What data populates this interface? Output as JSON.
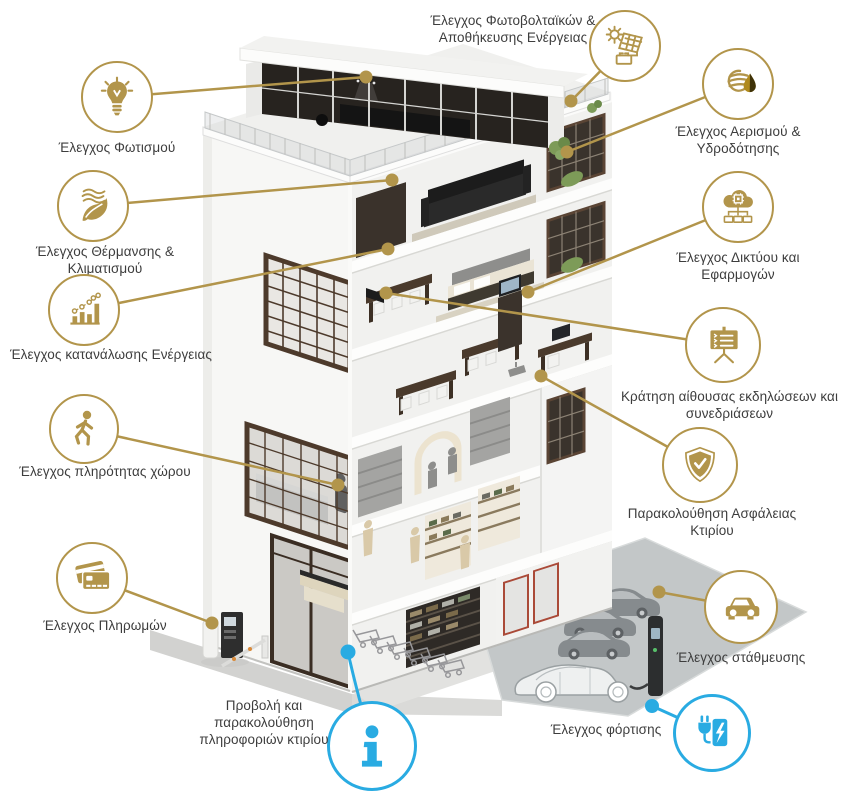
{
  "figure": {
    "type": "smart-building-infographic",
    "colors": {
      "accent_gold": "#b2954b",
      "accent_blue": "#29abe2",
      "label_text": "#3d3d3d"
    }
  },
  "callouts": [
    {
      "id": "lighting",
      "icon": "lightbulb-icon",
      "label": "Έλεγχος Φωτισμού"
    },
    {
      "id": "solar",
      "icon": "solar-panel-battery-icon",
      "label": "Έλεγχος Φωτοβολταϊκών & Αποθήκευσης Ενέργειας"
    },
    {
      "id": "ventilation",
      "icon": "airflow-waterdrop-icon",
      "label": "Έλεγχος Αερισμού & Υδροδότησης"
    },
    {
      "id": "hvac",
      "icon": "leaf-breeze-icon",
      "label": "Έλεγχος Θέρμανσης & Κλιματισμού"
    },
    {
      "id": "network",
      "icon": "cloud-network-icon",
      "label": "Έλεγχος Δικτύου και Εφαρμογών"
    },
    {
      "id": "energy",
      "icon": "bar-chart-icon",
      "label": "Έλεγχος κατανάλωσης Ενέργειας"
    },
    {
      "id": "meeting",
      "icon": "presentation-board-icon",
      "label": "Κράτηση αίθουσας εκδηλώσεων και συνεδριάσεων"
    },
    {
      "id": "occupancy",
      "icon": "walking-person-icon",
      "label": "Έλεγχος πληρότητας χώρου"
    },
    {
      "id": "security",
      "icon": "shield-check-icon",
      "label": "Παρακολούθηση Ασφάλειας Κτιρίου"
    },
    {
      "id": "payments",
      "icon": "credit-cards-icon",
      "label": "Έλεγχος Πληρωμών"
    },
    {
      "id": "parking",
      "icon": "car-icon",
      "label": "Έλεγχος στάθμευσης"
    },
    {
      "id": "charging",
      "icon": "ev-plug-icon",
      "label": "Έλεγχος φόρτισης"
    },
    {
      "id": "info",
      "icon": "info-icon",
      "label": "Προβολή και παρακολούθηση πληροφοριών κτιρίου"
    }
  ]
}
